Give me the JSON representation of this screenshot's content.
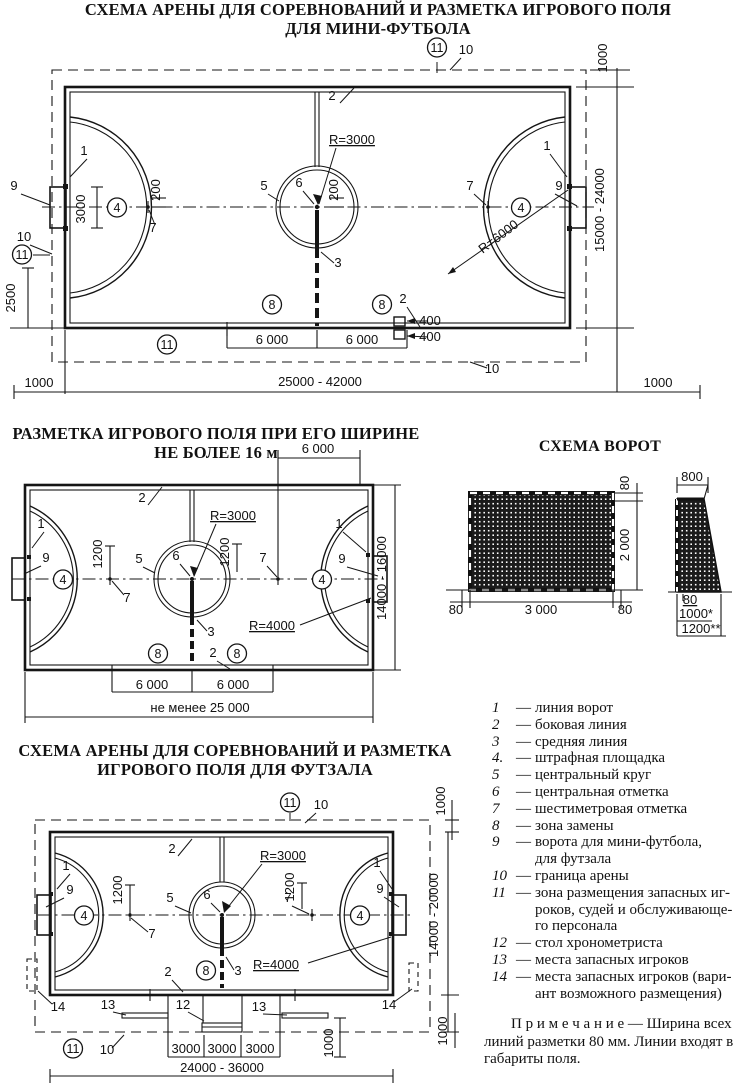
{
  "page": {
    "bg": "#ffffff",
    "ink": "#151515"
  },
  "titles": {
    "mini_line1": "СХЕМА АРЕНЫ ДЛЯ СОРЕВНОВАНИЙ И РАЗМЕТКА ИГРОВОГО ПОЛЯ",
    "mini_line2": "ДЛЯ МИНИ-ФУТБОЛА",
    "width16_line1": "РАЗМЕТКА ИГРОВОГО ПОЛЯ ПРИ ЕГО ШИРИНЕ",
    "width16_line2": "НЕ БОЛЕЕ 16 м",
    "goal": "СХЕМА ВОРОТ",
    "futsal_line1": "СХЕМА АРЕНЫ ДЛЯ СОРЕВНОВАНИЙ И РАЗМЕТКА",
    "futsal_line2": "ИГРОВОГО ПОЛЯ ДЛЯ ФУТЗАЛА"
  },
  "legend": {
    "items": [
      {
        "num": "1",
        "text": "линия ворот"
      },
      {
        "num": "2",
        "text": "боковая линия"
      },
      {
        "num": "3",
        "text": "средняя линия"
      },
      {
        "num": "4.",
        "text": "штрафная площадка"
      },
      {
        "num": "5",
        "text": "центральный круг"
      },
      {
        "num": "6",
        "text": "центральная отметка"
      },
      {
        "num": "7",
        "text": "шестиметровая отметка"
      },
      {
        "num": "8",
        "text": "зона замены"
      },
      {
        "num": "9",
        "text": "ворота для мини-футбола,\nдля футзала"
      },
      {
        "num": "10",
        "text": "граница арены"
      },
      {
        "num": "11",
        "text": "зона размещения запасных иг-\nроков, судей и обслуживающе-\nго персонала"
      },
      {
        "num": "12",
        "text": "стол хронометриста"
      },
      {
        "num": "13",
        "text": "места запасных игроков"
      },
      {
        "num": "14",
        "text": "места запасных игроков (вари-\nант возможного размещения)"
      }
    ]
  },
  "note": {
    "text": "П р и м е ч а н и е — Ширина всех линий разметки 80 мм. Линии входят в габариты поля."
  },
  "diagram_mini_football": {
    "labels": [
      {
        "t": "11",
        "x": 437,
        "y": 12,
        "c": 1
      },
      {
        "t": "10",
        "x": 466,
        "y": 14
      },
      {
        "t": "1000",
        "x": 607,
        "y": 18,
        "r": -90
      },
      {
        "t": "2",
        "x": 332,
        "y": 60
      },
      {
        "t": "R=3000",
        "x": 352,
        "y": 104,
        "u": 1
      },
      {
        "t": "1",
        "x": 84,
        "y": 115
      },
      {
        "t": "1",
        "x": 547,
        "y": 110
      },
      {
        "t": "9",
        "x": 14,
        "y": 150
      },
      {
        "t": "9",
        "x": 559,
        "y": 150
      },
      {
        "t": "3000",
        "x": 85,
        "y": 169,
        "r": -90
      },
      {
        "t": "4",
        "x": 117,
        "y": 172,
        "c": 1
      },
      {
        "t": "4",
        "x": 521,
        "y": 172,
        "c": 1
      },
      {
        "t": "200",
        "x": 160,
        "y": 150,
        "r": -90,
        "fs": 12
      },
      {
        "t": "200",
        "x": 338,
        "y": 150,
        "r": -90,
        "fs": 12
      },
      {
        "t": "5",
        "x": 264,
        "y": 150
      },
      {
        "t": "6",
        "x": 299,
        "y": 147
      },
      {
        "t": "7",
        "x": 153,
        "y": 192
      },
      {
        "t": "7",
        "x": 470,
        "y": 150
      },
      {
        "t": "R=6000",
        "x": 501,
        "y": 200,
        "r": -37
      },
      {
        "t": "10",
        "x": 24,
        "y": 201
      },
      {
        "t": "11",
        "x": 22,
        "y": 219,
        "c": 1
      },
      {
        "t": "15000 - 24000",
        "x": 604,
        "y": 170,
        "r": -90
      },
      {
        "t": "2500",
        "x": 15,
        "y": 258,
        "r": -90
      },
      {
        "t": "3",
        "x": 338,
        "y": 227
      },
      {
        "t": "8",
        "x": 272,
        "y": 269,
        "c": 1
      },
      {
        "t": "2",
        "x": 403,
        "y": 263
      },
      {
        "t": "8",
        "x": 382,
        "y": 269,
        "c": 1
      },
      {
        "t": "400",
        "x": 430,
        "y": 285,
        "a": "start",
        "fs": 12.5
      },
      {
        "t": "400",
        "x": 430,
        "y": 301,
        "a": "start",
        "fs": 12.5
      },
      {
        "t": "6 000",
        "x": 272,
        "y": 304
      },
      {
        "t": "6 000",
        "x": 362,
        "y": 304
      },
      {
        "t": "11",
        "x": 167,
        "y": 309,
        "c": 1
      },
      {
        "t": "10",
        "x": 492,
        "y": 333
      },
      {
        "t": "1000",
        "x": 39,
        "y": 347
      },
      {
        "t": "25000 - 42000",
        "x": 320,
        "y": 346,
        "fs": 14
      },
      {
        "t": "1000",
        "x": 658,
        "y": 347
      }
    ]
  },
  "diagram_width16": {
    "labels": [
      {
        "t": "6 000",
        "x": 318,
        "y": 13
      },
      {
        "t": "2",
        "x": 142,
        "y": 62
      },
      {
        "t": "R=3000",
        "x": 233,
        "y": 80,
        "u": 1
      },
      {
        "t": "1",
        "x": 41,
        "y": 88
      },
      {
        "t": "1",
        "x": 339,
        "y": 88
      },
      {
        "t": "9",
        "x": 46,
        "y": 122
      },
      {
        "t": "9",
        "x": 342,
        "y": 123
      },
      {
        "t": "4",
        "x": 63,
        "y": 144,
        "c": 1
      },
      {
        "t": "4",
        "x": 322,
        "y": 144,
        "c": 1
      },
      {
        "t": "1200",
        "x": 102,
        "y": 114,
        "r": -90,
        "fs": 12
      },
      {
        "t": "1200",
        "x": 229,
        "y": 112,
        "r": -90,
        "fs": 12
      },
      {
        "t": "5",
        "x": 139,
        "y": 123
      },
      {
        "t": "6",
        "x": 176,
        "y": 120
      },
      {
        "t": "7",
        "x": 127,
        "y": 162
      },
      {
        "t": "7",
        "x": 263,
        "y": 122
      },
      {
        "t": "14000 - 16000",
        "x": 386,
        "y": 138,
        "r": -90
      },
      {
        "t": "R=4000",
        "x": 272,
        "y": 190,
        "u": 1
      },
      {
        "t": "3",
        "x": 211,
        "y": 196
      },
      {
        "t": "2",
        "x": 213,
        "y": 217
      },
      {
        "t": "8",
        "x": 158,
        "y": 218,
        "c": 1
      },
      {
        "t": "8",
        "x": 237,
        "y": 218,
        "c": 1
      },
      {
        "t": "6 000",
        "x": 152,
        "y": 249
      },
      {
        "t": "6 000",
        "x": 233,
        "y": 249
      },
      {
        "t": "не менее 25 000",
        "x": 200,
        "y": 272,
        "fs": 14
      }
    ]
  },
  "diagram_goal": {
    "labels": [
      {
        "t": "800",
        "x": 252,
        "y": 26,
        "fs": 12
      },
      {
        "t": "80",
        "x": 189,
        "y": 28,
        "r": -90,
        "fs": 11.5
      },
      {
        "t": "2 000",
        "x": 189,
        "y": 90,
        "r": -90,
        "fs": 12.5
      },
      {
        "t": "80",
        "x": 16,
        "y": 159,
        "fs": 11.5
      },
      {
        "t": "3 000",
        "x": 101,
        "y": 159,
        "fs": 12.5
      },
      {
        "t": "80",
        "x": 185,
        "y": 159,
        "fs": 11.5
      },
      {
        "t": "80",
        "x": 250,
        "y": 149,
        "fs": 11,
        "u": 1
      },
      {
        "t": "1000*",
        "x": 256,
        "y": 163,
        "fs": 11.5
      },
      {
        "t": "1200**",
        "x": 261,
        "y": 178,
        "fs": 11.5
      }
    ]
  },
  "diagram_futsal": {
    "labels": [
      {
        "t": "11",
        "x": 290,
        "y": 22,
        "c": 1
      },
      {
        "t": "10",
        "x": 321,
        "y": 24
      },
      {
        "t": "1000",
        "x": 445,
        "y": 16,
        "r": -90,
        "fs": 12
      },
      {
        "t": "2",
        "x": 172,
        "y": 68
      },
      {
        "t": "R=3000",
        "x": 283,
        "y": 75,
        "u": 1
      },
      {
        "t": "1",
        "x": 66,
        "y": 85
      },
      {
        "t": "1",
        "x": 377,
        "y": 82
      },
      {
        "t": "9",
        "x": 70,
        "y": 109
      },
      {
        "t": "9",
        "x": 380,
        "y": 108
      },
      {
        "t": "4",
        "x": 84,
        "y": 135,
        "c": 1
      },
      {
        "t": "4",
        "x": 360,
        "y": 135,
        "c": 1
      },
      {
        "t": "1200",
        "x": 122,
        "y": 105,
        "r": -90,
        "fs": 12
      },
      {
        "t": "1200",
        "x": 294,
        "y": 102,
        "r": -90,
        "fs": 12
      },
      {
        "t": "5",
        "x": 170,
        "y": 117
      },
      {
        "t": "6",
        "x": 207,
        "y": 114
      },
      {
        "t": "7",
        "x": 152,
        "y": 153
      },
      {
        "t": "7",
        "x": 288,
        "y": 117
      },
      {
        "t": "R=4000",
        "x": 276,
        "y": 184,
        "u": 1
      },
      {
        "t": "2",
        "x": 168,
        "y": 191
      },
      {
        "t": "8",
        "x": 206,
        "y": 190,
        "c": 1
      },
      {
        "t": "3",
        "x": 238,
        "y": 190
      },
      {
        "t": "14",
        "x": 58,
        "y": 226
      },
      {
        "t": "13",
        "x": 108,
        "y": 224
      },
      {
        "t": "12",
        "x": 183,
        "y": 224
      },
      {
        "t": "13",
        "x": 259,
        "y": 226
      },
      {
        "t": "14",
        "x": 389,
        "y": 224
      },
      {
        "t": "11",
        "x": 73,
        "y": 268,
        "c": 1
      },
      {
        "t": "10",
        "x": 107,
        "y": 269
      },
      {
        "t": "3000",
        "x": 186,
        "y": 268,
        "fs": 12
      },
      {
        "t": "3000",
        "x": 222,
        "y": 268,
        "fs": 12
      },
      {
        "t": "3000",
        "x": 260,
        "y": 268,
        "fs": 12
      },
      {
        "t": "1000",
        "x": 333,
        "y": 258,
        "r": -90,
        "fs": 12
      },
      {
        "t": "1000",
        "x": 447,
        "y": 246,
        "r": -90,
        "fs": 12
      },
      {
        "t": "14000 - 20000",
        "x": 438,
        "y": 130,
        "r": -90
      },
      {
        "t": "24000 - 36000",
        "x": 222,
        "y": 287,
        "fs": 14
      }
    ]
  }
}
